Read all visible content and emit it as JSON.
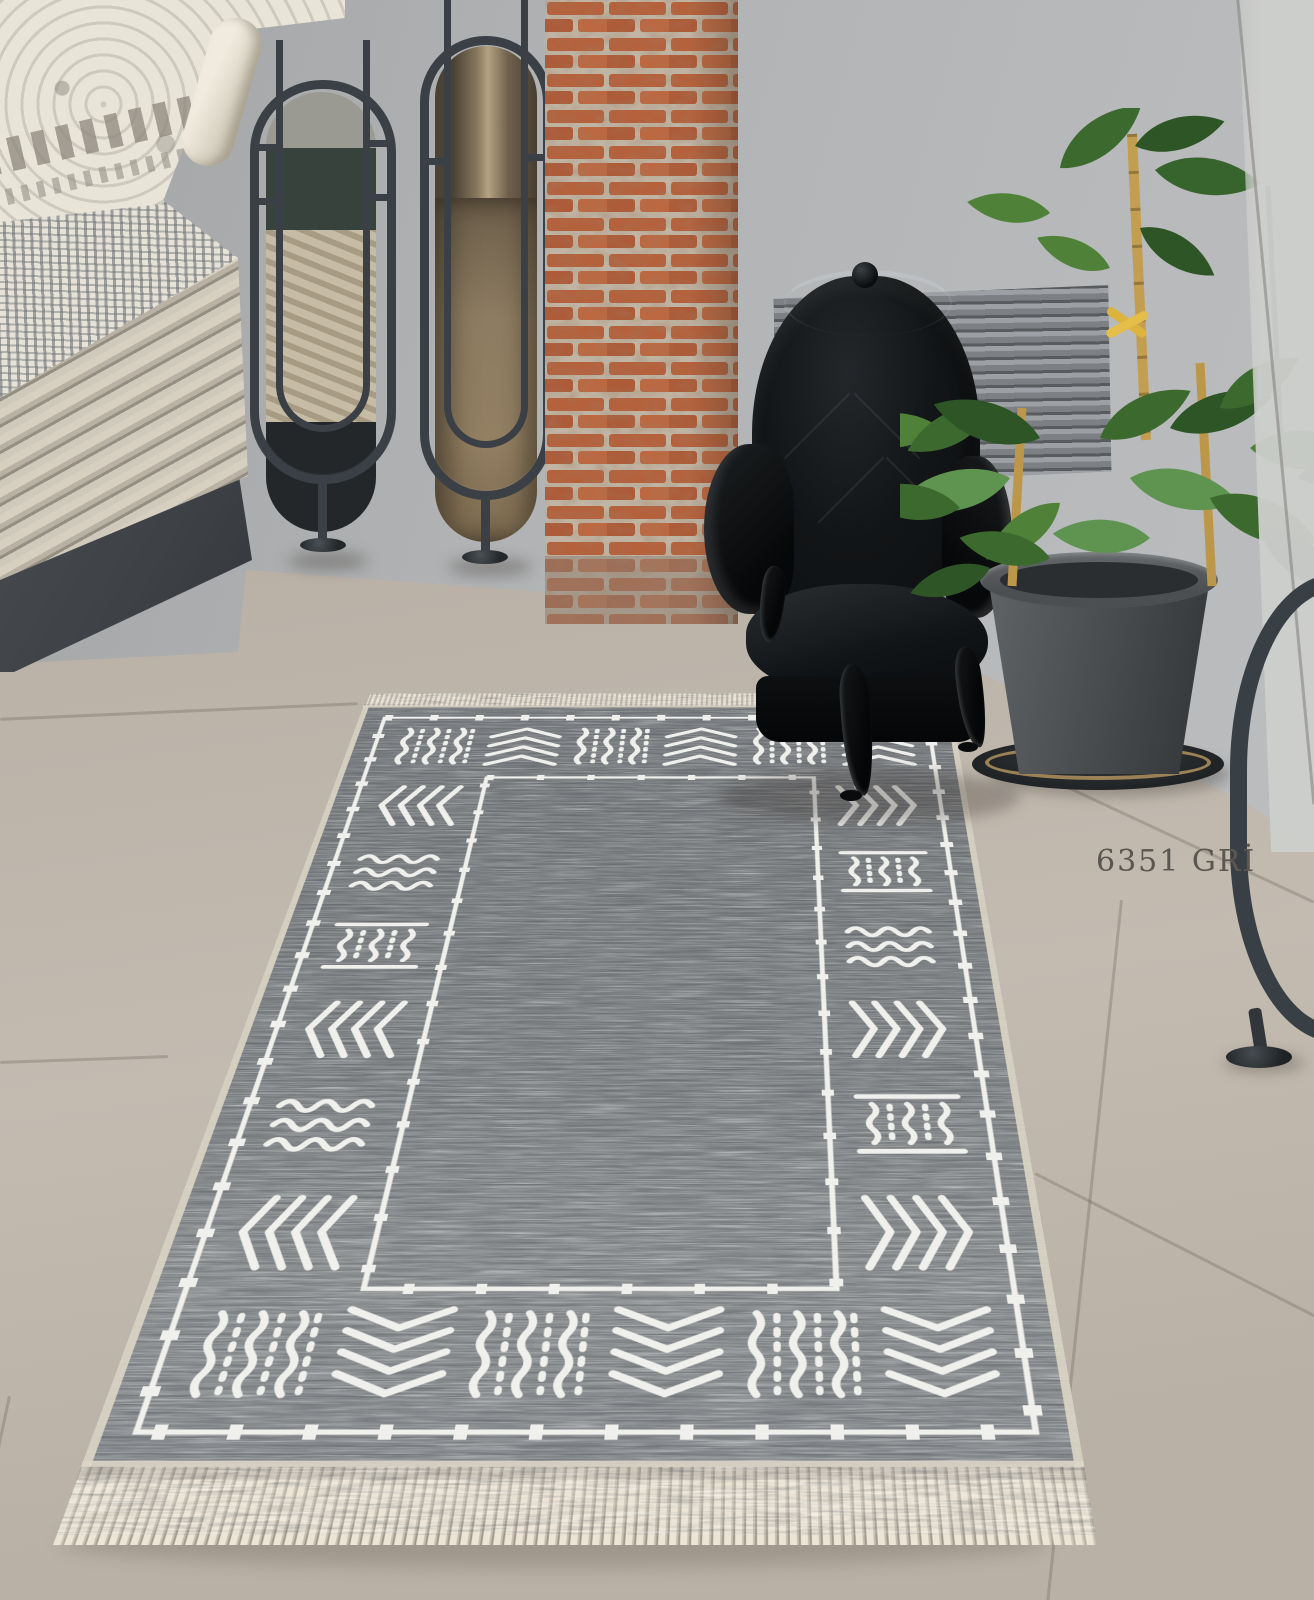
{
  "product_label": {
    "text": "6351 GRİ"
  },
  "scene": {
    "rug": {
      "style": "mudcloth-border",
      "motifs": [
        "chevron-stack",
        "wavy-lines",
        "lattice-bars",
        "squiggle-dash-columns",
        "diamond-bead-lines"
      ],
      "fringe_edges": [
        "top",
        "bottom"
      ]
    },
    "objects": [
      "stacked-rugs-bench",
      "oval-mirror-stand-left",
      "oval-mirror-stand-right",
      "brick-pillar",
      "louver-vent",
      "black-armchair",
      "potted-plant",
      "gray-area-rug",
      "metal-frame-fragment-right",
      "colorway-label"
    ]
  },
  "palette": {
    "wall": "#b1b3b5",
    "wall_shade": "#a2a4a6",
    "floor": "#b8afa5",
    "floor_light": "#c3bbb0",
    "bench": "#3e4246",
    "stack_cream": "#d7d0c1",
    "ivory_rug": "#e9e4d8",
    "distressed": "#e6e2d8",
    "metal": "#3a4045",
    "brick": "#b5613c",
    "mortar": "#c0b5a4",
    "vent": "#8f9396",
    "chair_black": "#0d0f11",
    "pot": "#4b4f51",
    "saucer_ring": "#a98e5f",
    "leaf_dark": "#2e5526",
    "leaf_mid": "#3c6a2e",
    "leaf_light": "#4f8138",
    "cane": "#c49e50",
    "tie_yellow": "#dcb33c",
    "rug_field": "#7a7e81",
    "rug_pattern": "#f3f3f0",
    "fringe": "#eae3d3",
    "label_text": "#5b564f"
  }
}
